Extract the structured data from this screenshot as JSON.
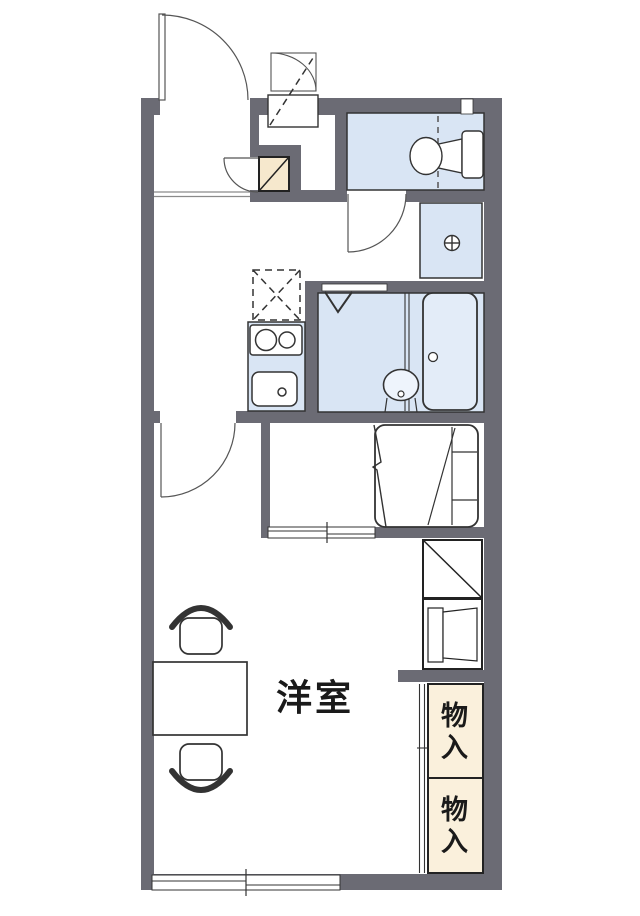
{
  "plan_title": "1K apartment floor plan",
  "rooms": {
    "western_room": {
      "label": "洋室"
    },
    "storage_upper": {
      "label": "物入"
    },
    "storage_lower": {
      "label": "物入"
    }
  },
  "fixtures": [
    "entrance-door",
    "shoe-cabinet",
    "outdoor-storage-closet",
    "toilet",
    "washing-machine-pan",
    "refrigerator-space",
    "two-burner-stove",
    "kitchen-sink",
    "bathroom-folding-door",
    "washbasin",
    "bathtub",
    "single-bed",
    "desk-table",
    "chair",
    "chair",
    "storage-box",
    "water-heater-cabinet",
    "closet-upper",
    "closet-lower",
    "sliding-window-south",
    "sliding-window-alcove",
    "toilet-small-window"
  ],
  "colors": {
    "wall": "#6b6b74",
    "room_blue": "#d9e5f4",
    "fixture_white": "#ffffff",
    "beige": "#f6e8cd",
    "closet_beige": "#faf0dc",
    "line": "#333333",
    "thin_line": "#555555",
    "text": "#1a1a1a",
    "bg": "#ffffff"
  }
}
